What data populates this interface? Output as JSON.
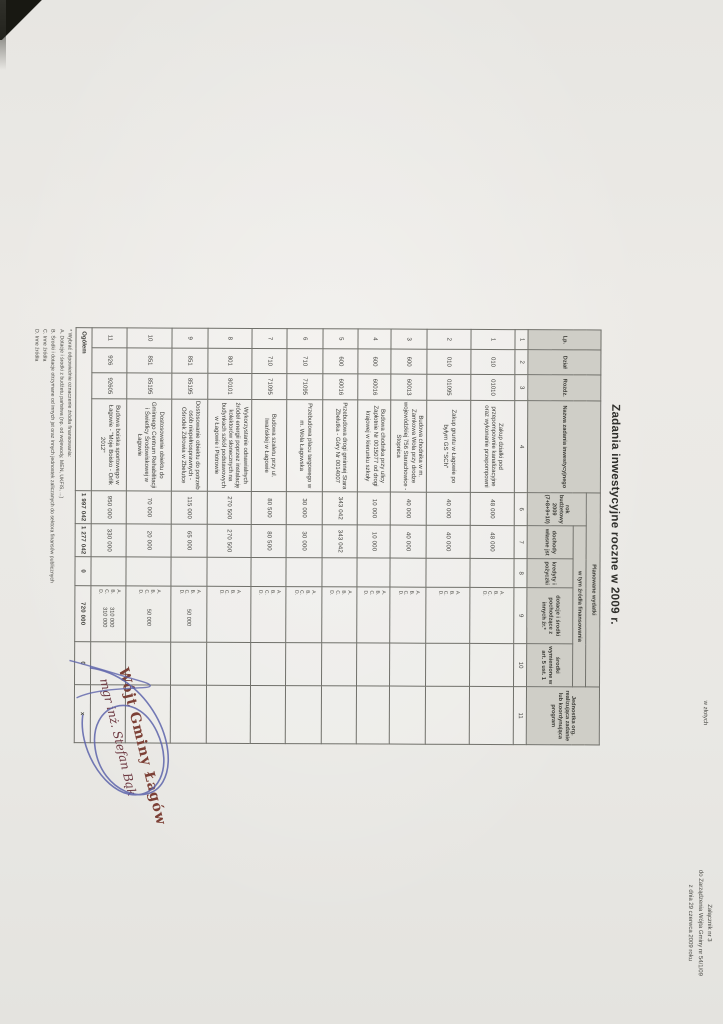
{
  "attachment_note": {
    "line1": "Załącznik nr 3",
    "line2": "do Zarządzenia Wójta Gminy nr 54/1/09",
    "line3": "z dnia 29 czerwca 2009 roku"
  },
  "title": "Zadania inwestycyjne roczne w 2009 r.",
  "currency_note": "w złotych",
  "table": {
    "headers": {
      "lp": "Lp.",
      "dzial": "Dział",
      "rozdz": "Rozdz.",
      "nazwa": "Nazwa zadania inwestycyjnego",
      "planowane": "Planowane wydatki",
      "rok": "rok budżetowy 2009 (7+8+9+10)",
      "zrodla": "w tym źródła finansowania",
      "dochody": "dochody własne jst",
      "kredyty": "kredyty i pożyczki",
      "dotacje": "dotacje i środki pochodzące z innych źr.*",
      "srodki": "środki wymienione w art. 5 ust. 1",
      "jednostka": "Jednostka org. realizująca zadanie lub koordynująca program"
    },
    "column_numbers": [
      "1",
      "2",
      "3",
      "4",
      "6",
      "7",
      "8",
      "9",
      "10",
      "11"
    ],
    "source_letters": [
      "A.",
      "B.",
      "C.",
      "D."
    ],
    "rows": [
      {
        "lp": "1",
        "dzial": "010",
        "rozdz": "01010",
        "nazwa": "Zakup działki pod przepompownie kanalizacyjne oraz wykonanie przepompowni",
        "rok": "48 000",
        "dochody": "48 000",
        "kredyty": "",
        "dotacje_values": [],
        "srodki": "",
        "jednostka": ""
      },
      {
        "lp": "2",
        "dzial": "010",
        "rozdz": "01095",
        "nazwa": "Zakup gruntu w Łagowie po byłym GS \"SCh\"",
        "rok": "40 000",
        "dochody": "40 000",
        "kredyty": "",
        "dotacje_values": [],
        "srodki": "",
        "jednostka": ""
      },
      {
        "lp": "3",
        "dzial": "600",
        "rozdz": "60013",
        "nazwa": "Budowa chodnika w m. Zamkowa Wola przy drodze wojewódzkiej 756 Starachowice - Stopnica",
        "rok": "40 000",
        "dochody": "40 000",
        "kredyty": "",
        "dotacje_values": [],
        "srodki": "",
        "jednostka": ""
      },
      {
        "lp": "4",
        "dzial": "600",
        "rozdz": "60016",
        "nazwa": "Budowa chodnika przy ulicy Zapłotnie Nr 0015077 od drogi krajowej w kierunku szkoły",
        "rok": "10 000",
        "dochody": "10 000",
        "kredyty": "",
        "dotacje_values": [],
        "srodki": "",
        "jednostka": ""
      },
      {
        "lp": "5",
        "dzial": "600",
        "rozdz": "60016",
        "nazwa": "Przebudowa drogi gminnej Stara Zbelutka - Góry Nr 0014007",
        "rok": "343 042",
        "dochody": "343 042",
        "kredyty": "",
        "dotacje_values": [],
        "srodki": "",
        "jednostka": ""
      },
      {
        "lp": "6",
        "dzial": "710",
        "rozdz": "71095",
        "nazwa": "Przebudowa placu targowego w m. Wola Łagowska",
        "rok": "30 000",
        "dochody": "30 000",
        "kredyty": "",
        "dotacje_values": [],
        "srodki": "",
        "jednostka": ""
      },
      {
        "lp": "7",
        "dzial": "710",
        "rozdz": "71095",
        "nazwa": "Budowa szaletu przy ul. Iwańskiej w Łagowie",
        "rok": "80 500",
        "dochody": "80 500",
        "kredyty": "",
        "dotacje_values": [],
        "srodki": "",
        "jednostka": ""
      },
      {
        "lp": "8",
        "dzial": "801",
        "rozdz": "80101",
        "nazwa": "Wykorzystanie odnawialnych źródeł energii poprzez instalację kolektorów słonecznych na budynkach szkół podstawowych w Łagowie i Piotrowie",
        "rok": "270 500",
        "dochody": "270 500",
        "kredyty": "",
        "dotacje_values": [],
        "srodki": "",
        "jednostka": ""
      },
      {
        "lp": "9",
        "dzial": "851",
        "rozdz": "85195",
        "nazwa": "Dostosowanie obiektu do potrzeb osób niepełnosprawnych - Ośrodek Zdrowia w Zbelutce",
        "rok": "115 000",
        "dochody": "65 000",
        "kredyty": "",
        "dotacje_values": [
          "50 000"
        ],
        "srodki": "",
        "jednostka": ""
      },
      {
        "lp": "10",
        "dzial": "851",
        "rozdz": "85195",
        "nazwa": "Dostosowanie obiektu do Gminnego Centrum Rehabilitacji i Świetlicy Środowiskowej w Łagowie",
        "rok": "70 000",
        "dochody": "20 000",
        "kredyty": "",
        "dotacje_values": [
          "50 000"
        ],
        "srodki": "",
        "jednostka": ""
      },
      {
        "lp": "11",
        "dzial": "926",
        "rozdz": "92605",
        "nazwa": "Budowa boiska sportowego w Łagowie - \"Moje Boisko - Orlik 2012\"",
        "rok": "950 000",
        "dochody": "330 000",
        "kredyty": "",
        "dotacje_values": [
          "310 000",
          "310 000"
        ],
        "srodki": "",
        "jednostka": ""
      }
    ],
    "total": {
      "label": "Ogółem",
      "rok": "1 997 042",
      "dochody": "1 277 042",
      "kredyty": "0",
      "dotacje": "720 000",
      "srodki": "0",
      "jednostka": "x"
    }
  },
  "footnotes": [
    "* Wybrać odpowiednie oznaczenie źródła finansowania:",
    "A. Dotacje i środki z budżetu państwa (np. od wojewody, MEN, UKFiS, ...)",
    "B. Środki i dotacje otrzymane od innych jst oraz innych jednostek zaliczanych do sektora finansów publicznych",
    "C. Inne źródła",
    "D. Inne źródła"
  ],
  "signature": {
    "line1": "Wójt Gminy Łagów",
    "line2": "mgr inż. Stefan Bąk"
  },
  "colors": {
    "stamp_red": "#7c4036",
    "signature_ink_blue": "#5c63aa",
    "paper": "#e9e8e4",
    "table_line": "#70706a",
    "header_fill": "#cfcec7"
  }
}
